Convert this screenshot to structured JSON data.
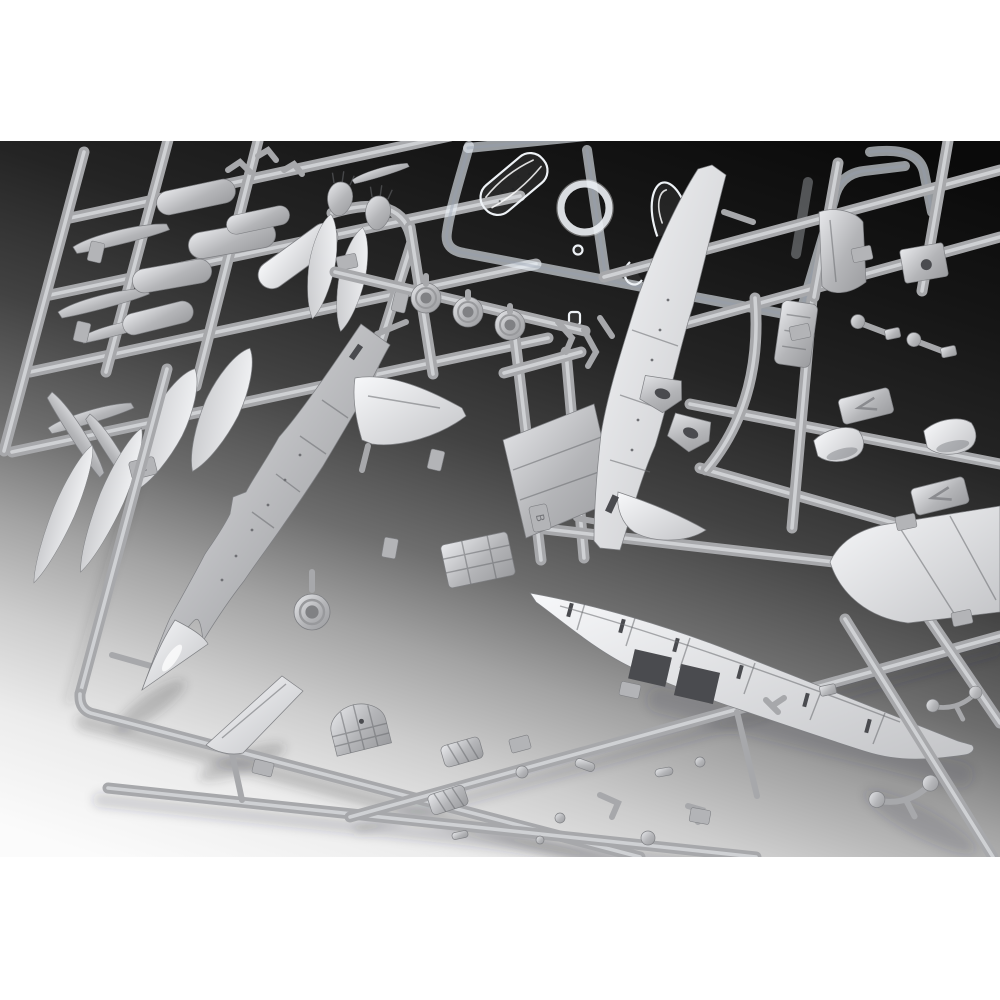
{
  "meta": {
    "title": "Plastic model kit sprues photo",
    "description": "Overhead studio photograph of an aircraft plastic model kit: three overlapping light-gray injection-molded sprues (parts trees) holding fuselage halves, a one-piece lower wing, wing panels, drop tanks, bombs, wheels, cockpit and landing-gear parts, plus one clear sprue with canopy, windscreen and a gunsight ring. Background fades from dark charcoal at top to near-white at bottom-left; white margins above and below the photo."
  },
  "sprues": [
    {
      "letter": "C",
      "name": "tanks-and-ordnance-sprue",
      "contents": [
        "drop tank halves",
        "cylindrical fuel tank halves",
        "pylon blades",
        "finned bombs",
        "sway braces"
      ]
    },
    {
      "letter": "B",
      "name": "main-airframe-sprue",
      "contents": [
        "left fuselage half",
        "right fuselage half",
        "nose cone",
        "tail fins",
        "horizontal stabilizer",
        "one-piece lower wing",
        "upper wing panels",
        "cockpit tub",
        "instrument coaming",
        "ejection seat",
        "wheels",
        "landing gear legs",
        "gear doors",
        "intake scoops",
        "intake ramps",
        "small fittings"
      ]
    },
    {
      "letter": "",
      "name": "clear-parts-sprue",
      "contents": [
        "bubble canopy",
        "windscreen",
        "gunsight ring",
        "small lenses"
      ]
    }
  ],
  "colors": {
    "frame_white": "#ffffff",
    "bg0": "#0a0a0a",
    "bg1": "#161616",
    "bg2": "#242424",
    "bg3": "#424242",
    "bg4": "#6e6e6e",
    "bg5": "#a3a3a3",
    "bg6": "#cdcdcd",
    "bg7": "#ececec",
    "bg8": "#fbfbfb",
    "runner": "#a7a8ab",
    "runner_hi": "#d4d5d8",
    "part_light": "#e8e9ec",
    "part_mid": "#b4b5b8",
    "part_dark": "#9b9c9f",
    "bright_light": "#f7f8fa",
    "bright_dark": "#c3c4c7",
    "part_edge": "#7f8084",
    "detail_dark": "#6a6b6f",
    "slot_dark": "#4a4b4f",
    "tag_fill": "#b3b4b7",
    "clear_edge": "#eef2f6",
    "clear_runner": "rgba(233,239,246,0.62)",
    "shadow": "rgba(48,50,58,0.22)",
    "nose_hi": "#ffffff"
  }
}
